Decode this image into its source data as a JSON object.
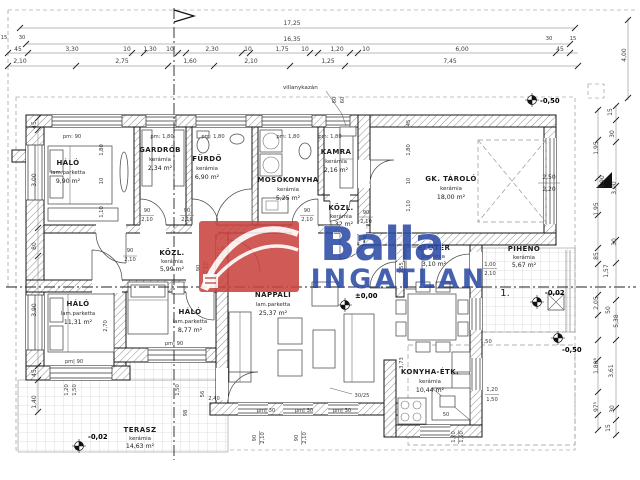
{
  "logo": {
    "brand": "Balla",
    "name": "INGATLAN",
    "red": "#c9423e",
    "blue": "#2b4aa5"
  },
  "rooms": {
    "halo1": {
      "name": "HÁLÓ",
      "floor": "lam.parketta",
      "area": "9,90 m²"
    },
    "gardrob": {
      "name": "GARDRÓB",
      "floor": "kerámia",
      "area": "2,34 m²"
    },
    "furdo": {
      "name": "FÜRDŐ",
      "floor": "kerámia",
      "area": "6,90 m²"
    },
    "mosokonyha": {
      "name": "MOSÓKONYHA",
      "floor": "kerámia",
      "area": "5,25 m²"
    },
    "kamra": {
      "name": "KAMRA",
      "floor": "kerámia",
      "area": "2,16 m²"
    },
    "kozl_top": {
      "name": "KÖZL.",
      "floor": "kerámia",
      "area": "1,32 m²"
    },
    "gk_tarolo": {
      "name": "GK. TÁROLÓ",
      "floor": "kerámia",
      "area": "18,00 m²"
    },
    "kozl": {
      "name": "KÖZL.",
      "floor": "kerámia",
      "area": "5,99 m²"
    },
    "halo2": {
      "name": "HÁLÓ",
      "floor": "lam.parketta",
      "area": "11,31 m²"
    },
    "halo3": {
      "name": "HÁLÓ",
      "floor": "lam.parketta",
      "area": "8,77 m²"
    },
    "nappali": {
      "name": "NAPPALI",
      "floor": "lam.parketta",
      "area": "25,37 m²"
    },
    "eloter": {
      "name": "ELŐTÉR",
      "floor": "kerámia",
      "area": "3,10 m²"
    },
    "piheno": {
      "name": "PIHENŐ",
      "floor": "kerámia",
      "area": "5,67 m²"
    },
    "konyha": {
      "name": "KONYHA-ÉTK.",
      "floor": "kerámia",
      "area": "10,44 m²"
    },
    "terasz": {
      "name": "TERASZ",
      "floor": "kerámia",
      "area": "14,63 m²"
    }
  },
  "levels": {
    "zero": "±0,00",
    "m02": "-0,02",
    "m05": "-0,50"
  },
  "ann": {
    "villanykazan": "villanykazán",
    "one": "1.",
    "gw": "2,50",
    "gh": "2,20",
    "blind": "30/25"
  },
  "pm": {
    "p90": "pm: 90",
    "p180": "pm: 1,80",
    "p90b": "pm| 90",
    "p30": "pm| 30"
  },
  "door": {
    "w": "90",
    "w2": "1,00",
    "h": "2,10"
  },
  "dims": {
    "total1": "17,25",
    "total2": "16,35",
    "rowA": [
      "45",
      "3,30",
      "10",
      "1,30",
      "10",
      "2,30",
      "10",
      "1,75",
      "10",
      "1,20",
      "10",
      "6,00",
      "45"
    ],
    "rowB": [
      "2,10",
      "2,75",
      "1,60",
      "2,10",
      "1,25",
      "7,45"
    ],
    "cl": [
      "15",
      "30"
    ],
    "cr": [
      "30",
      "15"
    ],
    "left": [
      "45",
      "3,00",
      "80",
      "3,90",
      "45",
      "1,40"
    ],
    "right": [
      "15",
      "30",
      "1,95",
      "3,90",
      "3,00",
      "1,95",
      "30",
      "85",
      "1,57",
      "2,05",
      "50",
      "5,38",
      "1,80⁶",
      "3,61",
      "97⁵",
      "30",
      "15",
      "4,00"
    ],
    "m": {
      "d180": "1,80",
      "d10": "10",
      "d110": "1,10",
      "d270": "2,70",
      "d120": "1,20",
      "d150": "1,50",
      "d155": "1,55",
      "d56": "56",
      "d240": "2,40",
      "d98": "98",
      "d60": "60",
      "d45": "45",
      "d50": "50",
      "d373": "3,73"
    }
  }
}
